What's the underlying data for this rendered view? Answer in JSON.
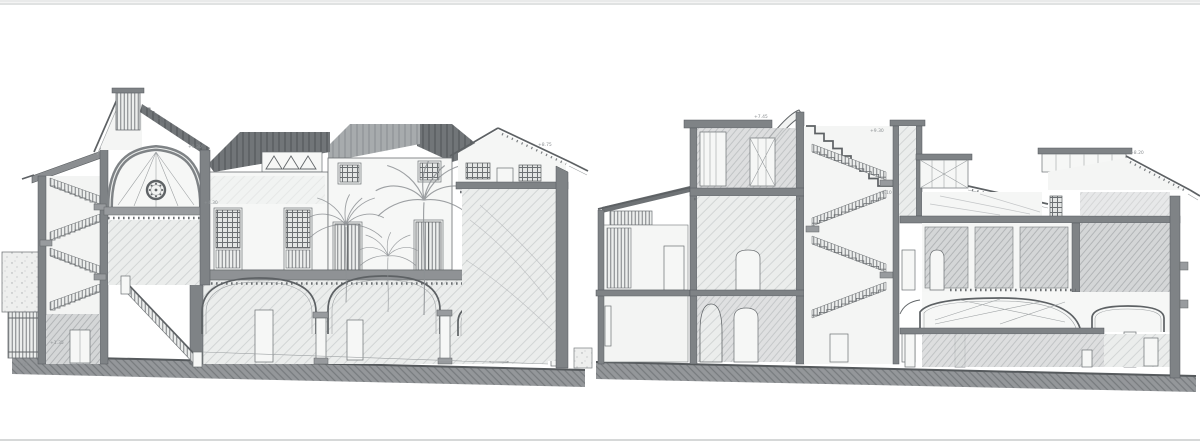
{
  "sheet": {
    "background": "#ffffff",
    "top_edge_color": "#c2c4c5",
    "bottom_edge_color": "#c9cbcb"
  },
  "palette": {
    "ink_line": "#63676a",
    "cut_wall_poche": "#7f8386",
    "dark_roof_tiles": "#717578",
    "light_pencil_hatch": "#d8dadb",
    "ground_fill": "#94979a",
    "paper": "#f6f7f6"
  },
  "annotations": {
    "left_eave": "+9.30",
    "left_dome_spring": "+4.30",
    "left_wing_eave": "+8.75",
    "left_stair_door": "+1.35",
    "left_ground": "±0.00",
    "right_block_top": "+7.45",
    "right_tower": "+9.30",
    "right_stair_mid": "+6.10",
    "right_eave": "+8.20"
  }
}
